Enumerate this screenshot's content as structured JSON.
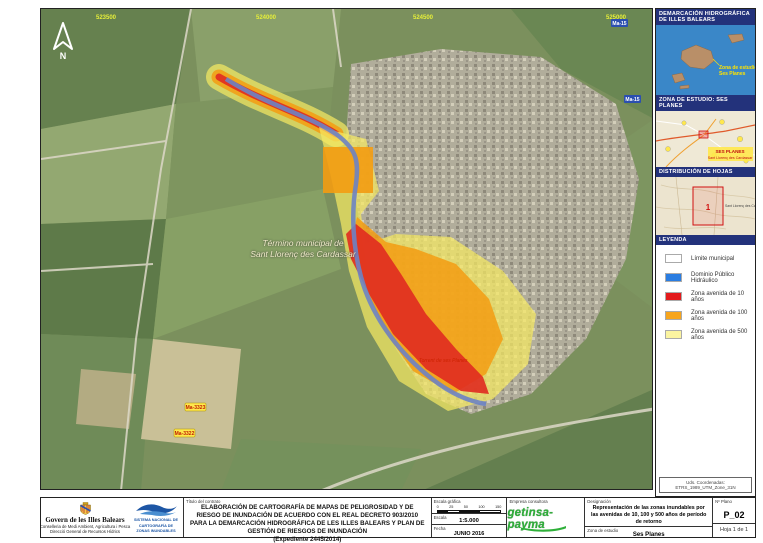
{
  "map": {
    "grid_labels": [
      "523500",
      "524000",
      "524500",
      "525000"
    ],
    "north_letter": "N",
    "municipality_label_line1": "Término municipal de",
    "municipality_label_line2": "Sant Llorenç des Cardassar",
    "torrent_label": "Torrent de ses Planes",
    "road_shields": {
      "yellow1": "Ma-3323",
      "yellow2": "Ma-3322",
      "blue1": "Ma-15",
      "blue2": "Ma-15"
    },
    "overlay_colors": {
      "dph_blue": "#6d83c4",
      "q10_red": "#e02b20",
      "q100_orange": "#f39c12",
      "q500_yellow": "#f5e963"
    }
  },
  "sidebar": {
    "panel1_title": "DEMARCACIÓN HIDROGRÁFICA DE ILLES BALEARS",
    "islands_label_line1": "Zona de estudio",
    "islands_label_line2": "Ses Planes",
    "panel2_title": "ZONA DE ESTUDIO: SES PLANES",
    "roadmap_label_line1": "SES PLANES",
    "roadmap_label_line2": "Sant Llorenç des Cardassar",
    "panel3_title": "DISTRIBUCIÓN DE HOJAS",
    "hoja_number": "1",
    "topo_town_label": "Sant Llorenç des Cardassar",
    "panel4_title": "LEYENDA",
    "legend": [
      {
        "label": "Límite municipal",
        "color": "#ffffff"
      },
      {
        "label": "Dominio Público Hidráulico",
        "color": "#2a7de1"
      },
      {
        "label": "Zona avenida de 10 años",
        "color": "#e31a1c"
      },
      {
        "label": "Zona avenida de 100 años",
        "color": "#f7a51c"
      },
      {
        "label": "Zona avenida de 500 años",
        "color": "#fbf4a0"
      }
    ],
    "coords_note": "Uds. Coordenadas: ETRS_1989_UTM_Zone_31N"
  },
  "titleblock": {
    "govern_line1": "Govern de les Illes Balears",
    "govern_line2": "Conselleria de Medi Ambient, Agricultura i Pesca",
    "govern_line3": "Direcció General de Recursos Hídrics",
    "snczi_line1": "SISTEMA NACIONAL DE",
    "snczi_line2": "CARTOGRAFÍA DE",
    "snczi_line3": "ZONAS INUNDABLES",
    "project_label": "Título del contrato",
    "project_title": "ELABORACIÓN DE CARTOGRAFÍA DE MAPAS DE PELIGROSIDAD Y DE RIESGO DE INUNDACIÓN DE ACUERDO CON EL REAL DECRETO 903/2010 PARA LA DEMARCACIÓN HIDROGRÁFICA DE LES ILLES BALEARS Y PLAN DE GESTIÓN DE RIESGOS DE INUNDACIÓN",
    "project_expediente": "(Expediente 2445/2014)",
    "escala_grafica_label": "Escala gráfica",
    "scalebar_ticks": [
      "0",
      "25",
      "50",
      "100",
      "150"
    ],
    "escala_label": "Escala",
    "escala_value": "1:5.000",
    "fecha_label": "Fecha",
    "fecha_value": "JUNIO 2016",
    "empresa_label": "Empresa consultora",
    "empresa_logo": "getinsa-payma",
    "designacion_label": "Designación",
    "designacion_text": "Representación de las zonas inundables por las avenidas de 10, 100 y 500 años de período de retorno",
    "zona_estudio_label": "Zona de estudio",
    "zona_estudio_value": "Ses Planes",
    "plano_label": "Nº Plano",
    "plano_value": "P_02",
    "hoja_value": "Hoja 1 de 1"
  }
}
